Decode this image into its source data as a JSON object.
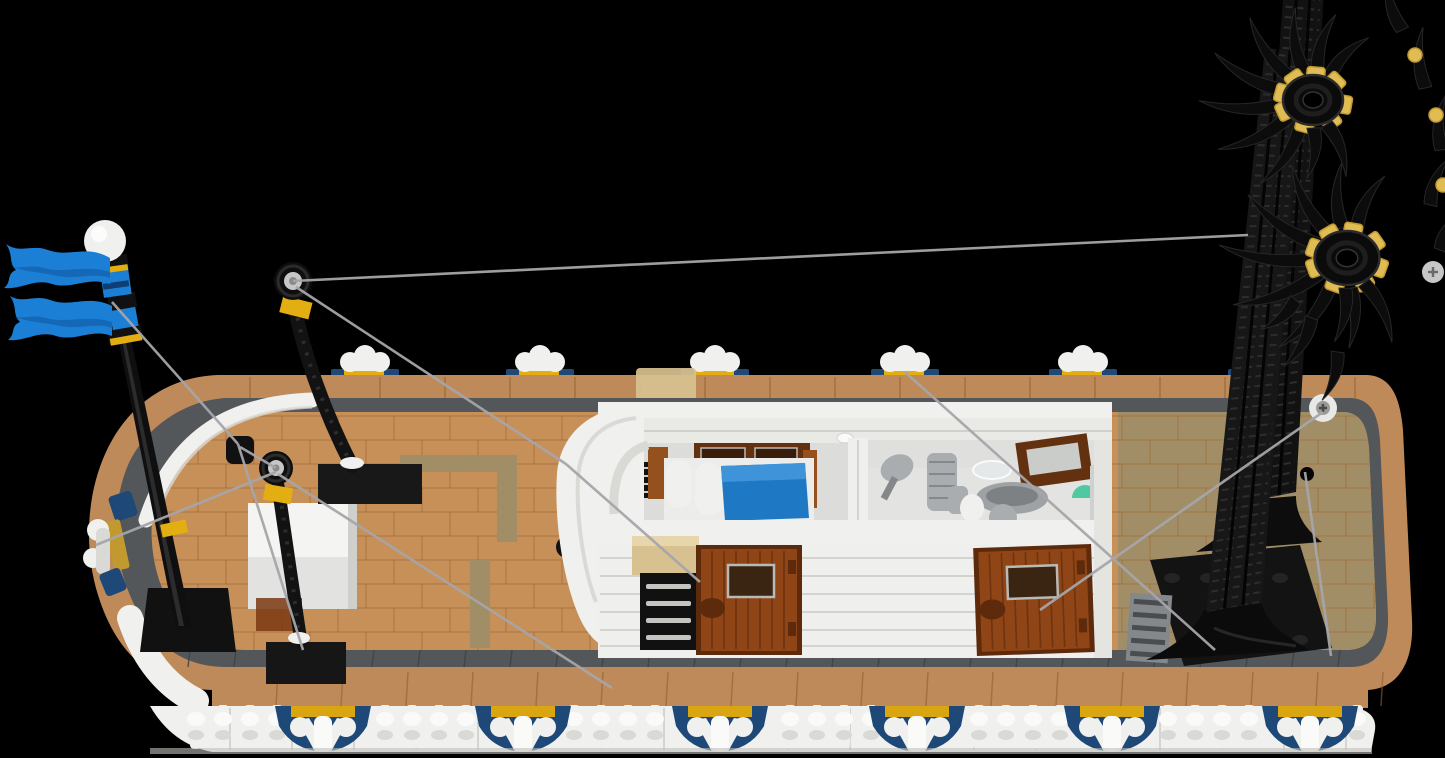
{
  "palette": {
    "background": "#000000",
    "gunwale_tan": "#bf8a59",
    "gunwale_edge": "#8f5f36",
    "deck_tan": "#c79059",
    "deck_line": "#a3713e",
    "deck_dark_tan": "#a28e66",
    "walkway_gray": "#53575a",
    "walkway_line": "#3e4245",
    "white": "#f0f0ee",
    "white_shade": "#d9d9d5",
    "white_dark": "#bfbfbb",
    "navy": "#1d4878",
    "accent_yellow": "#e3ae12",
    "flag_blue": "#1b7fd6",
    "flag_blue_dark": "#135ea8",
    "black": "#111111",
    "black_hi": "#2e2e2e",
    "door_brown": "#8f4516",
    "door_brown_dark": "#5d2a0c",
    "bed_brown": "#95511d",
    "headboard_brown": "#63310f",
    "blanket_blue": "#1f78c4",
    "fixture_gray": "#aaadaf",
    "fixture_gray_dark": "#85888a",
    "trans_green": "#3fc49b",
    "trans_tan": "#d8c190",
    "string_gray": "#a5a5aa",
    "silver": "#c7c7c7",
    "gold": "#c1992f",
    "gold_light": "#e0bc55"
  },
  "scene": {
    "far_ornaments_x": [
      365,
      540,
      715,
      905,
      1083,
      1262
    ],
    "near_ornaments_x": [
      323,
      523,
      720,
      917,
      1112,
      1310
    ],
    "far_balusters": {
      "y": 404,
      "h": 32,
      "step": 27,
      "ranges": [
        [
          228,
          596
        ],
        [
          1114,
          1338
        ]
      ]
    },
    "near_balusters": {
      "y": 705,
      "h": 44,
      "step": 27,
      "start": 196,
      "end": 1368
    },
    "rigging": [
      [
        293,
        281,
        1248,
        235
      ],
      [
        296,
        287,
        566,
        464
      ],
      [
        566,
        464,
        700,
        582
      ],
      [
        112,
        302,
        238,
        444
      ],
      [
        238,
        444,
        303,
        650
      ],
      [
        276,
        468,
        240,
        447
      ],
      [
        276,
        472,
        96,
        545
      ],
      [
        278,
        474,
        612,
        688
      ],
      [
        905,
        372,
        1215,
        650
      ],
      [
        1323,
        412,
        1040,
        610
      ],
      [
        1305,
        472,
        1331,
        656
      ]
    ],
    "crowns": [
      {
        "cx": 1313,
        "cy": 100,
        "s": 1.0,
        "claws": [
          [
            -155,
            70
          ],
          [
            -125,
            78
          ],
          [
            -98,
            85
          ],
          [
            -72,
            80
          ],
          [
            -45,
            75
          ],
          [
            -18,
            65
          ],
          [
            8,
            60
          ],
          [
            35,
            55
          ]
        ],
        "front": [
          [
            150,
            55
          ],
          [
            178,
            50
          ]
        ],
        "gold_angles": [
          -165,
          -115,
          -75,
          -35,
          5,
          45,
          100,
          145
        ]
      },
      {
        "cx": 1347,
        "cy": 258,
        "s": 1.08,
        "claws": [
          [
            -150,
            75
          ],
          [
            -120,
            85
          ],
          [
            -92,
            90
          ],
          [
            -65,
            80
          ],
          [
            -38,
            70
          ],
          [
            -10,
            60
          ],
          [
            18,
            55
          ]
        ],
        "front": [
          [
            145,
            60
          ],
          [
            172,
            55
          ],
          [
            -178,
            50
          ]
        ],
        "gold_angles": [
          -160,
          -110,
          -70,
          -30,
          10,
          55,
          110,
          150
        ]
      }
    ],
    "loose_claws": [
      [
        1312,
        318,
        -160,
        55
      ],
      [
        1338,
        352,
        -172,
        50
      ],
      [
        1296,
        300,
        -140,
        45
      ]
    ],
    "edge_claws": [
      [
        1402,
        30,
        -25,
        55
      ],
      [
        1425,
        88,
        -12,
        60
      ],
      [
        1441,
        150,
        -5,
        55
      ],
      [
        1430,
        205,
        12,
        50
      ],
      [
        1440,
        250,
        20,
        45
      ]
    ],
    "edge_gold": [
      [
        1415,
        55
      ],
      [
        1436,
        115
      ],
      [
        1443,
        185
      ]
    ],
    "plank_rows": {
      "y0": 416,
      "y1": 648,
      "step": 24,
      "tick_step": 56
    },
    "shutter_rows": [
      584,
      601,
      618,
      635
    ],
    "cabin_wall_lines": [
      558,
      576,
      594,
      612,
      630,
      646
    ]
  }
}
